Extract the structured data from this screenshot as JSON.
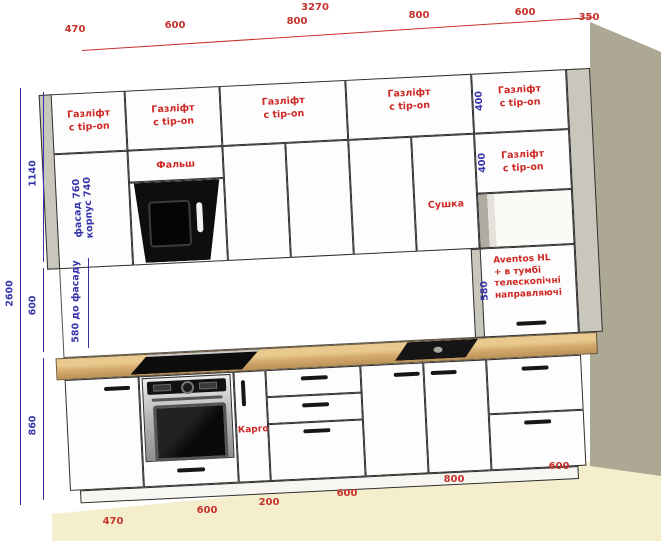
{
  "title": "Kitchen cabinet elevation drawing",
  "colors": {
    "dimension_red": "#c5322c",
    "dimension_blue": "#3734ab",
    "wall": "#aca893",
    "floor": "#f4eecd",
    "countertop": "#d4aa6e",
    "cabinet_front": "#fdfdfd",
    "hood_black": "#0e0e0e"
  },
  "dims": {
    "total_width": "3270",
    "top_segments": [
      "470",
      "600",
      "800",
      "800",
      "600"
    ],
    "side_depth": "350",
    "heights": {
      "total": "2600",
      "upper": "1140",
      "backsplash": "600",
      "base": "860"
    },
    "upper_right": [
      "400",
      "400"
    ],
    "aventos_height": "580",
    "backsplash_to_facade": "580 до фасаду",
    "left_door_facade": "фасад 760",
    "left_door_carcass": "корпус 740",
    "bottom_segments": [
      "470",
      "600",
      "200",
      "600",
      "800",
      "600"
    ]
  },
  "labels": {
    "gas_lift_1": "Газліфт",
    "gas_lift_2": "с tip-on",
    "falsh": "Фальш",
    "sushka": "Сушка",
    "kargo": "Карго",
    "aventos": [
      "Aventos HL",
      "+ в тумбі",
      "телескопічні",
      "направляючі"
    ]
  }
}
